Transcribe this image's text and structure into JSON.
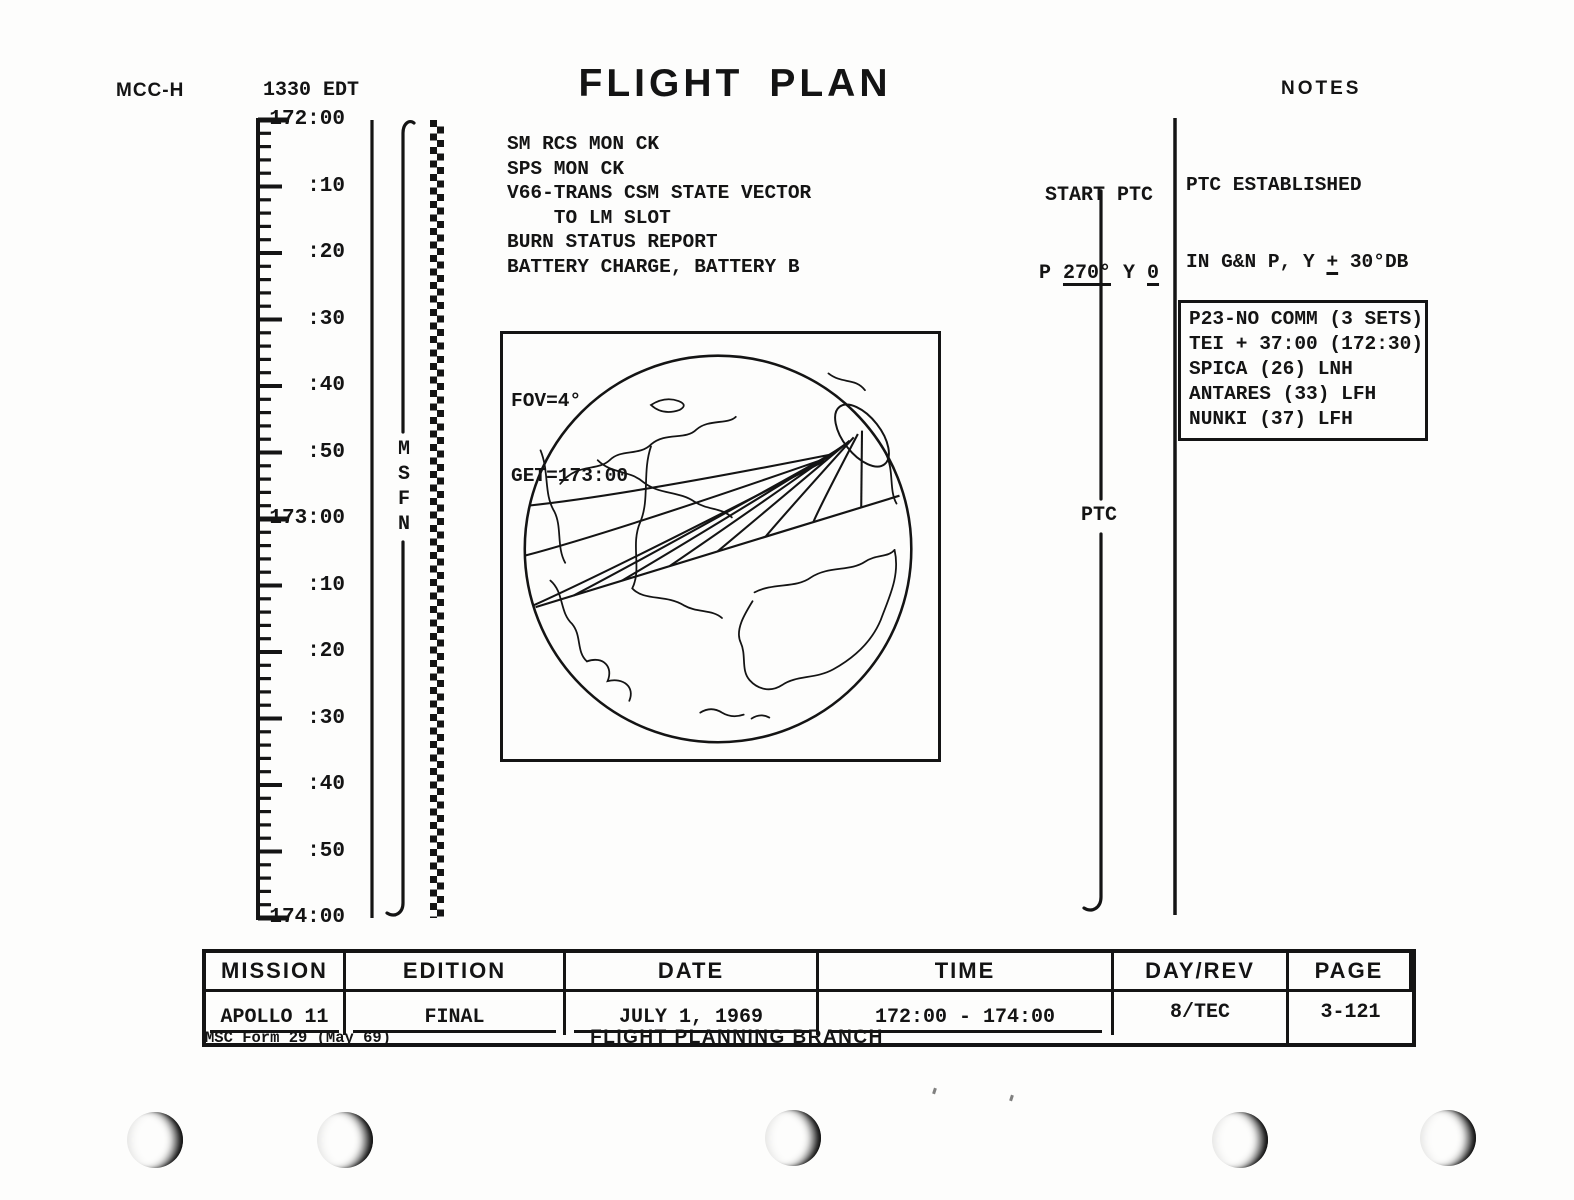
{
  "header": {
    "stamp": "MCC-H",
    "edt_time": "1330 EDT",
    "title_word1": "FLIGHT",
    "title_word2": "PLAN",
    "notes_header": "NOTES"
  },
  "timeline": {
    "labels": [
      "172:00",
      ":10",
      ":20",
      ":30",
      ":40",
      ":50",
      "173:00",
      ":10",
      ":20",
      ":30",
      ":40",
      ":50",
      "174:00"
    ],
    "network": "MSFN",
    "minor_tick_minutes": 2,
    "label_interval_minutes": 10
  },
  "tasks": {
    "lines": [
      "SM RCS MON CK",
      "SPS MON CK",
      "V66-TRANS CSM STATE VECTOR",
      "    TO LM SLOT",
      "BURN STATUS REPORT",
      "BATTERY CHARGE, BATTERY B"
    ]
  },
  "globe": {
    "fov_label": "FOV=4°",
    "get_label": "GET=173:00"
  },
  "ptc": {
    "start_title": "START PTC",
    "p_prefix": "P ",
    "p_value": "270°",
    "y_prefix": " Y ",
    "y_value": "0",
    "mid_label": "PTC"
  },
  "notes": {
    "established": {
      "line1": "PTC ESTABLISHED",
      "line2_pre": "IN G&N P, Y ",
      "line2_pm": "+",
      "line2_post": " 30°DB",
      "line3_pre": "R RATE OF 0.",
      "line3_digit": "3",
      "line3_post": "°/SEC"
    },
    "boxed_lines": [
      "P23-NO COMM (3 SETS)",
      "TEI + 37:00 (172:30)",
      "SPICA (26) LNH",
      "ANTARES (33) LFH",
      "NUNKI (37) LFH"
    ]
  },
  "footer_table": {
    "headers": [
      "MISSION",
      "EDITION",
      "DATE",
      "TIME",
      "DAY/REV",
      "PAGE"
    ],
    "values": [
      "APOLLO 11",
      "FINAL",
      "JULY 1, 1969",
      "172:00 - 174:00",
      "8/TEC",
      "3-121"
    ]
  },
  "footer": {
    "form_id": "MSC Form 29 (May 69)",
    "branch": "FLIGHT PLANNING BRANCH"
  }
}
